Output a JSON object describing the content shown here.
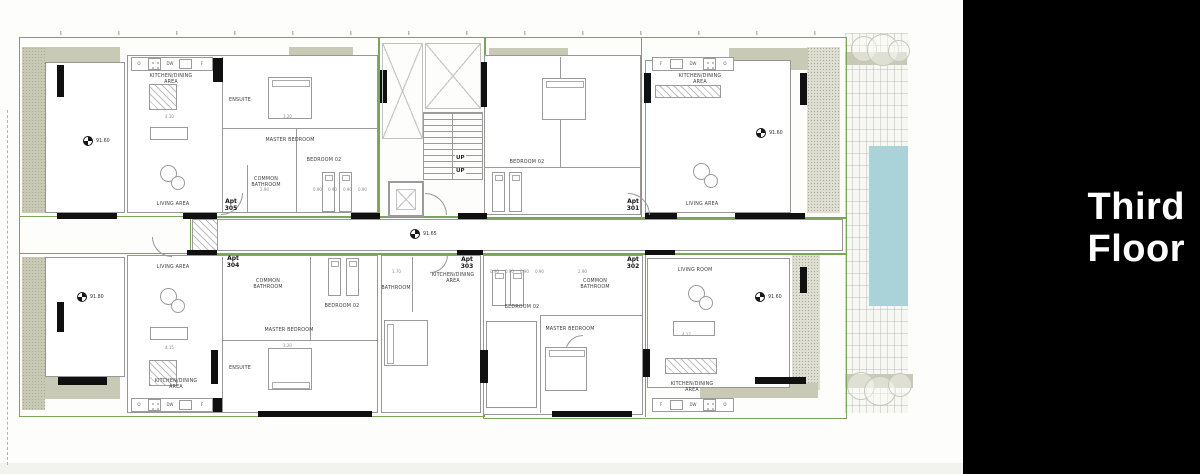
{
  "panel": {
    "title_line1": "Third",
    "title_line2": "Floor",
    "bg_color": "#000000",
    "text_color": "#ffffff"
  },
  "plan": {
    "levels": {
      "apt305_balcony": "91.60",
      "apt301_terrace": "91.60",
      "corridor": "91.65",
      "apt304_balcony": "91.80",
      "apt302_terrace": "91.60"
    },
    "core": {
      "up": "UP"
    },
    "kitchen_letters": [
      "O",
      "DW",
      "F"
    ],
    "apartments": [
      {
        "tag": "Apt",
        "num": "305",
        "rooms": {
          "kitchen": "KITCHEN/DINING AREA",
          "ensuite": "ENSUITE",
          "master": "MASTER BEDROOM",
          "bedroom2": "BEDROOM 02",
          "common_bath": "COMMON BATHROOM",
          "living": "LIVING AREA"
        }
      },
      {
        "tag": "Apt",
        "num": "301",
        "rooms": {
          "kitchen": "KITCHEN/DINING AREA",
          "bedroom2": "BEDROOM 02",
          "living": "LIVING AREA"
        }
      },
      {
        "tag": "Apt",
        "num": "304",
        "rooms": {
          "living": "LIVING AREA",
          "common_bath": "COMMON BATHROOM",
          "bedroom2": "BEDROOM 02",
          "master": "MASTER BEDROOM",
          "ensuite": "ENSUITE",
          "kitchen": "KITCHEN/DINING AREA"
        }
      },
      {
        "tag": "Apt",
        "num": "303",
        "rooms": {
          "bathroom": "BATHROOM",
          "kitchen": "KITCHEN/DINING AREA"
        }
      },
      {
        "tag": "Apt",
        "num": "302",
        "rooms": {
          "common_bath": "COMMON BATHROOM",
          "bedroom2": "BEDROOM 02",
          "master": "MASTER BEDROOM",
          "living": "LIVING ROOM",
          "kitchen": "KITCHEN/DINING AREA"
        }
      }
    ],
    "dims": [
      "4.10",
      "3.20",
      "2.90",
      "0.90",
      "0.90",
      "0.90",
      "0.90",
      "1.70",
      "4.15",
      "3.20",
      "2.90",
      "0.90",
      "0.90",
      "0.90",
      "0.90",
      "4.17"
    ],
    "colors": {
      "boundary_green": "#7aa456",
      "balcony_khaki": "#c9cab6",
      "pool_teal": "#a9d3d8",
      "wall_black": "#101010"
    }
  }
}
